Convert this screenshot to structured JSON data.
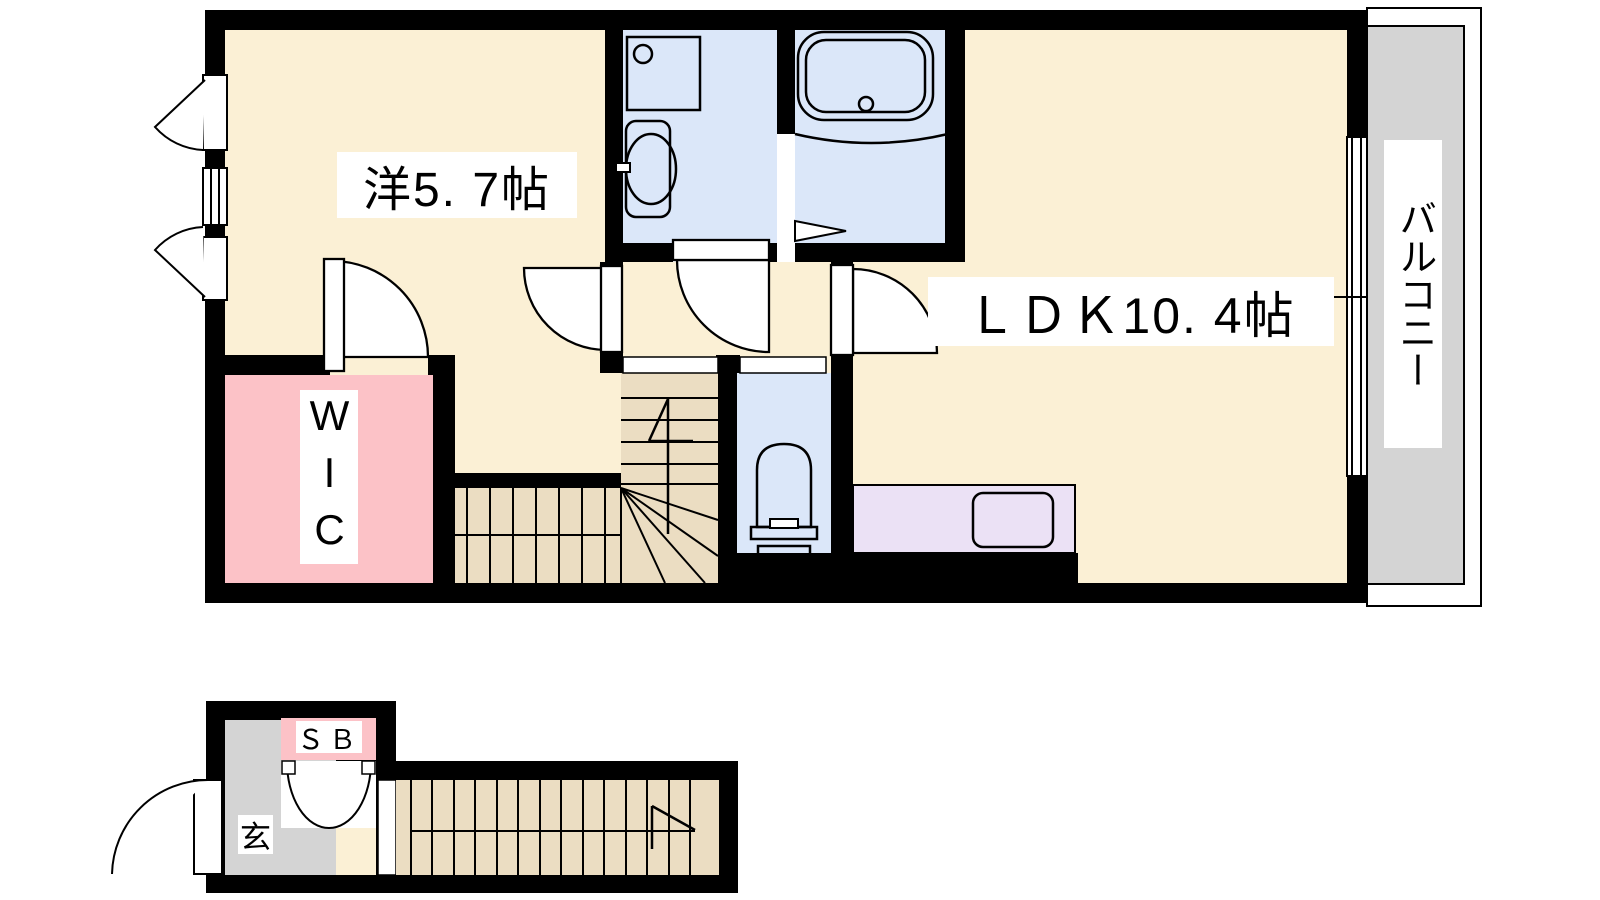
{
  "title": "apartment-floor-plan",
  "colors": {
    "floor": "#FBF0D5",
    "wet": "#DBE7F9",
    "closet": "#FCC2C7",
    "gray": "#D4D4D4",
    "counter": "#EBE1F5",
    "stairs": "#EBDDC2",
    "wall": "#000000",
    "line": "#000000",
    "background": "#FFFFFF"
  },
  "labels": {
    "bedroom": "洋5. 7帖",
    "ldk": "ＬＤＫ10. 4帖",
    "balcony": "バルコニー",
    "wic": "WIC",
    "shoe_box": "ＳＢ",
    "entrance": "玄"
  },
  "rooms": [
    {
      "id": "bedroom",
      "label": "洋5. 7帖",
      "type": "western-style room",
      "size_tatami": "5.7"
    },
    {
      "id": "ldk",
      "label": "ＬＤＫ10. 4帖",
      "type": "living-dining-kitchen",
      "size_tatami": "10.4"
    },
    {
      "id": "wic",
      "label": "WIC",
      "type": "walk-in closet"
    },
    {
      "id": "balcony",
      "label": "バルコニー",
      "type": "balcony"
    },
    {
      "id": "washroom",
      "type": "washroom with basin and washer pan"
    },
    {
      "id": "bathroom",
      "type": "bathroom with tub"
    },
    {
      "id": "toilet",
      "type": "toilet room"
    },
    {
      "id": "shoe_box",
      "label": "ＳＢ",
      "type": "shoe box"
    },
    {
      "id": "entrance",
      "label": "玄",
      "type": "entrance (genkan)"
    },
    {
      "id": "stairs",
      "type": "internal staircase"
    }
  ]
}
